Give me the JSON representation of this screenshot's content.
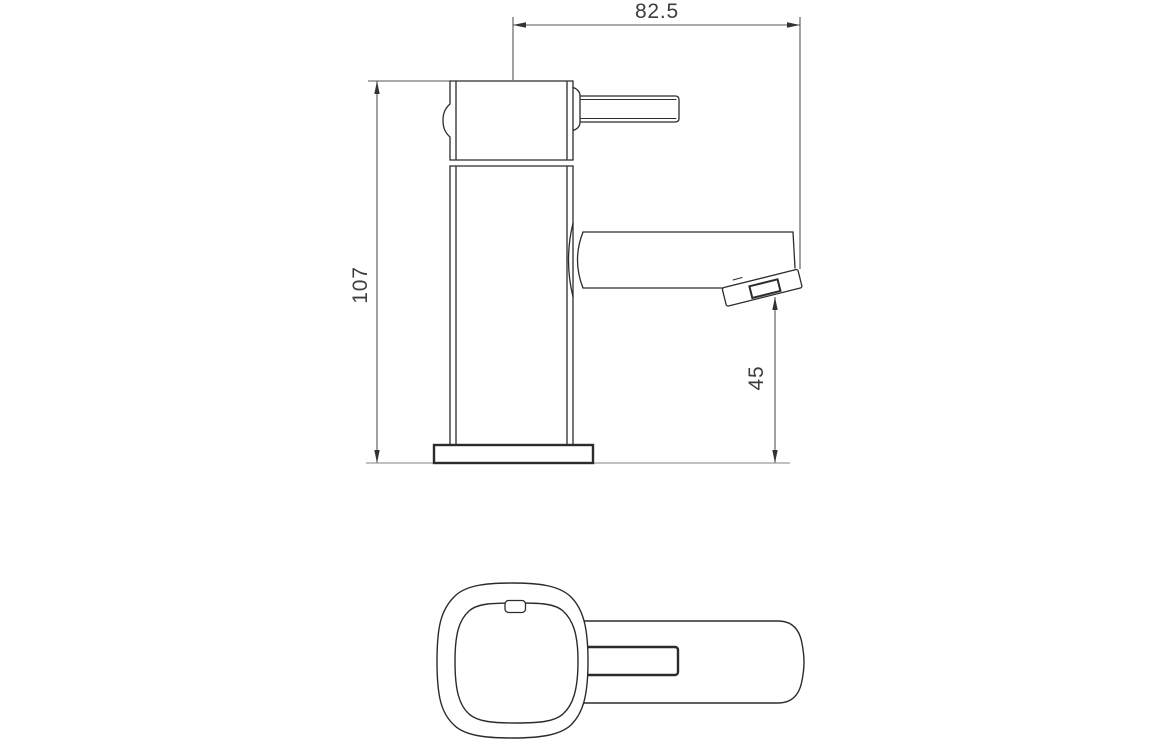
{
  "drawing": {
    "subject": "basin-mixer-tap-technical-drawing",
    "colors": {
      "line": "#2b2b2b",
      "dimension": "#555555",
      "arrow": "#333333",
      "ground": "#9b9b9b",
      "text": "#3d3d3d",
      "fill": "#ffffff"
    },
    "dimensions": {
      "overall_width": "82.5",
      "overall_height": "107",
      "spout_height": "45"
    }
  }
}
